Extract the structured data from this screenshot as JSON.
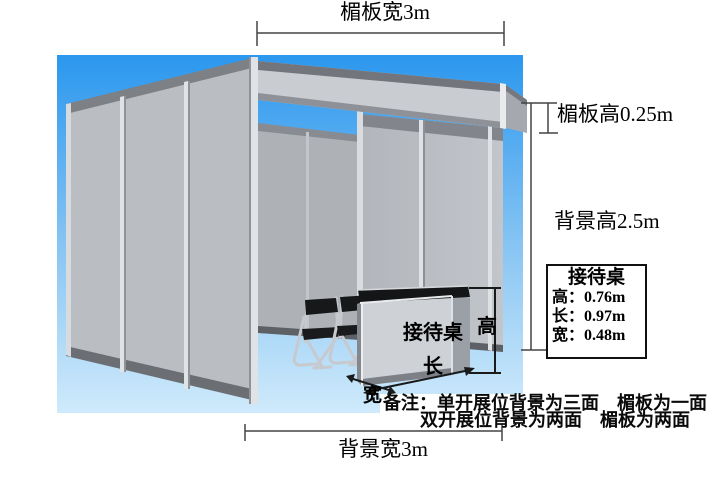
{
  "diagram": {
    "title_hint": "exhibition-booth-dimension-diagram",
    "dimensions": {
      "fascia_width": "楣板宽3m",
      "fascia_height": "楣板高0.25m",
      "background_height": "背景高2.5m",
      "background_width": "背景宽3m"
    },
    "desk": {
      "front_label": "接待桌",
      "height_arrow": "高",
      "length_arrow": "长",
      "width_arrow": "宽"
    },
    "info_box": {
      "title": "接待桌",
      "rows": [
        "高：0.76m",
        "长：0.97m",
        "宽：0.48m"
      ]
    },
    "notes": {
      "line1": "备注：单开展位背景为三面　楣板为一面",
      "line2": "双开展位背景为两面　楣板为两面"
    },
    "colors": {
      "sky_top": "#2B97EE",
      "sky_bottom": "#CFEAFB",
      "panel_light": "#BABEC3",
      "panel_interior": "#AEB2B7",
      "trim_dark": "#6B6F74",
      "beam_gray": "#C9CDD1",
      "aluminum": "#E0E3E6",
      "desk_top_black": "#141517",
      "chair_black": "#1A1B1D",
      "dimension_line": "#444444",
      "text": "#000000"
    }
  }
}
